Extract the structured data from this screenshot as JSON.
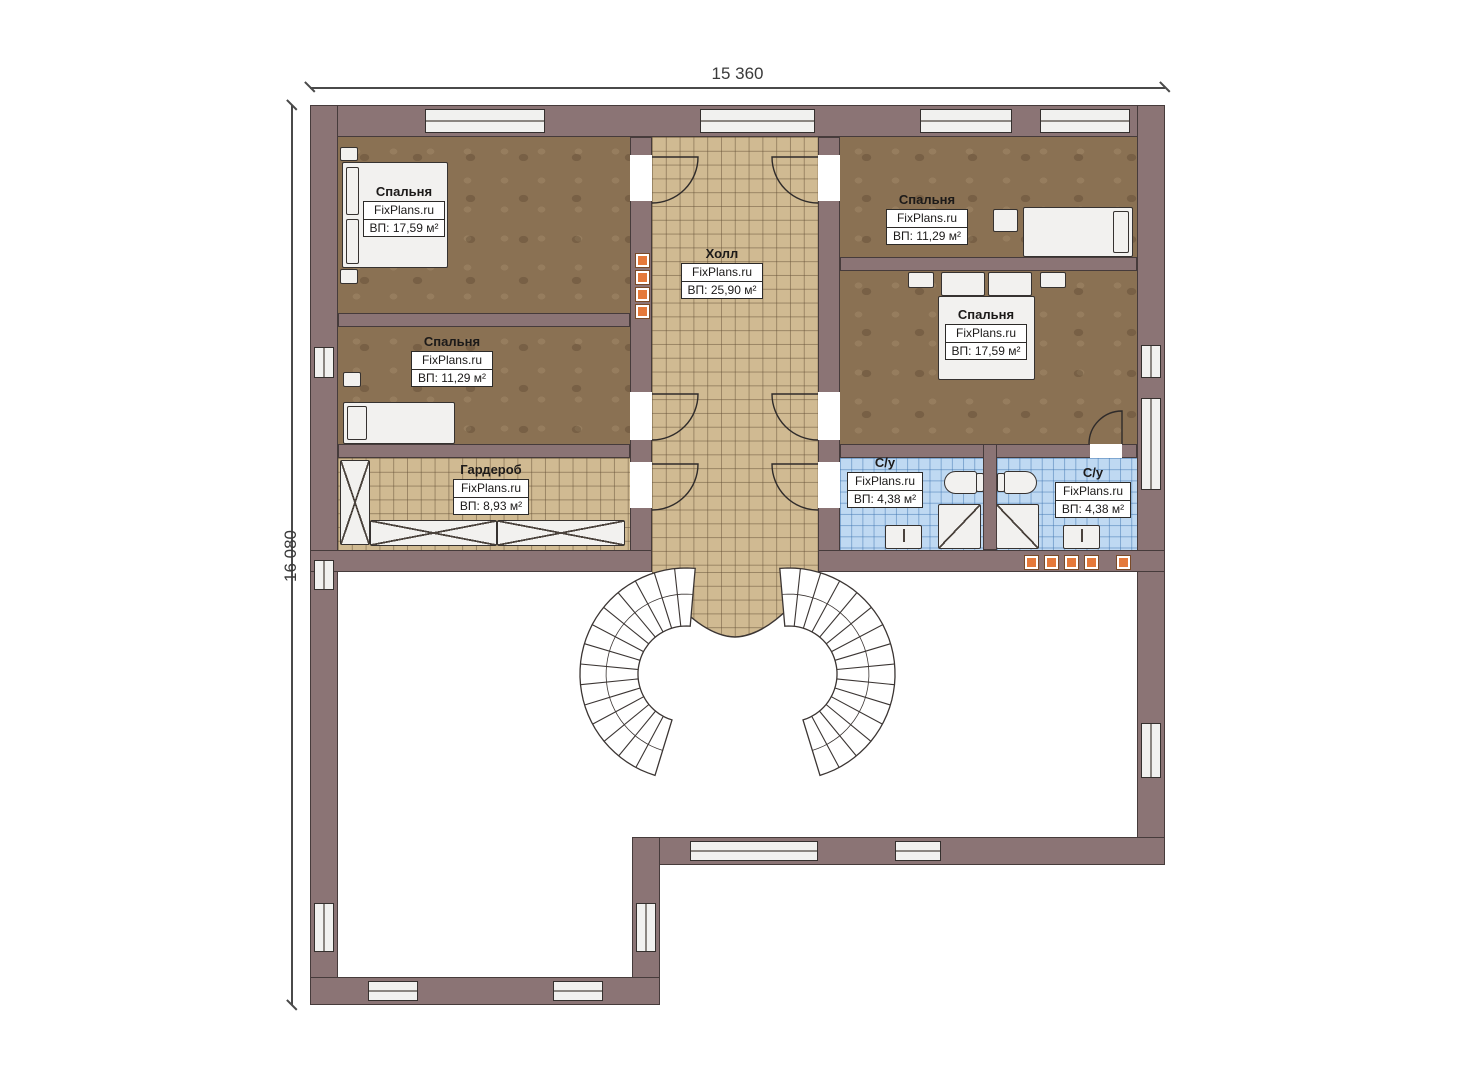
{
  "plan_title": "Second floor plan",
  "dimensions": {
    "width": "15 360",
    "height": "16 080"
  },
  "branding": "FixPlans.ru",
  "rooms": {
    "bedroom_top_left": {
      "name": "Спальня",
      "brand": "FixPlans.ru",
      "area": "ВП: 17,59 м²"
    },
    "bedroom_mid_left": {
      "name": "Спальня",
      "brand": "FixPlans.ru",
      "area": "ВП: 11,29 м²"
    },
    "hall": {
      "name": "Холл",
      "brand": "FixPlans.ru",
      "area": "ВП: 25,90 м²"
    },
    "bedroom_top_right": {
      "name": "Спальня",
      "brand": "FixPlans.ru",
      "area": "ВП: 11,29 м²"
    },
    "bedroom_mid_right": {
      "name": "Спальня",
      "brand": "FixPlans.ru",
      "area": "ВП: 17,59 м²"
    },
    "wardrobe": {
      "name": "Гардероб",
      "brand": "FixPlans.ru",
      "area": "ВП: 8,93 м²"
    },
    "bathroom_left": {
      "name": "С/у",
      "brand": "FixPlans.ru",
      "area": "ВП: 4,38 м²"
    },
    "bathroom_right": {
      "name": "С/у",
      "brand": "FixPlans.ru",
      "area": "ВП: 4,38 м²"
    }
  },
  "colors": {
    "wall": "#8b7475",
    "bedroom_floor": "#8a7153",
    "tile_floor": "#d0ba92",
    "bathroom_floor": "#bfd9f2",
    "fixture": "#f2f1ef",
    "accent_marker": "#e5793a"
  }
}
